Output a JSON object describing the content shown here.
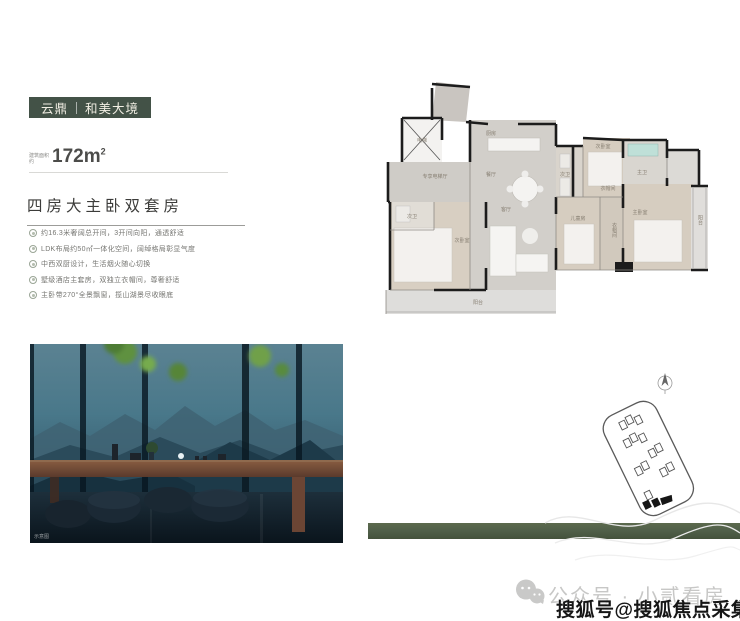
{
  "brand": {
    "left": "云鼎",
    "right": "和美大境",
    "badge_bg": "#435247"
  },
  "area": {
    "label_top": "建筑面积",
    "label_bottom": "约",
    "value": "172m",
    "sup": "2"
  },
  "headline": "四房大主卧双套房",
  "features": [
    {
      "text": "约16.3米奢阔总开间，3开间向阳，通透舒适"
    },
    {
      "text": "LDK布局约50㎡一体化空间，阔绰格局彰显气度"
    },
    {
      "text": "中西双厨设计，生活烟火随心切换"
    },
    {
      "text": "墅级酒店主套房，双独立衣帽间，尊奢舒适"
    },
    {
      "text": "主卧带270°全景飘窗，揽山湖景尽收眼底"
    }
  ],
  "floor_plan": {
    "rooms": [
      {
        "label": "电梯"
      },
      {
        "label": "专享电梯厅"
      },
      {
        "label": "厨房"
      },
      {
        "label": "餐厅"
      },
      {
        "label": "客厅"
      },
      {
        "label": "次卫"
      },
      {
        "label": "次卧室"
      },
      {
        "label": "阳台"
      },
      {
        "label": "次卫"
      },
      {
        "label": "次卧室"
      },
      {
        "label": "主卫"
      },
      {
        "label": "衣帽间"
      },
      {
        "label": "儿童房"
      },
      {
        "label": "衣帽间"
      },
      {
        "label": "主卧室"
      },
      {
        "label": "阳台"
      }
    ]
  },
  "photo": {
    "caption": "示意图"
  },
  "watermarks": {
    "wechat_text": "公众号 · 小贰看房",
    "sohu_text": "搜狐号@搜狐焦点采集站"
  },
  "colors": {
    "accent_bar": "#51604a",
    "plan_highlight": "#1a1a1a"
  }
}
